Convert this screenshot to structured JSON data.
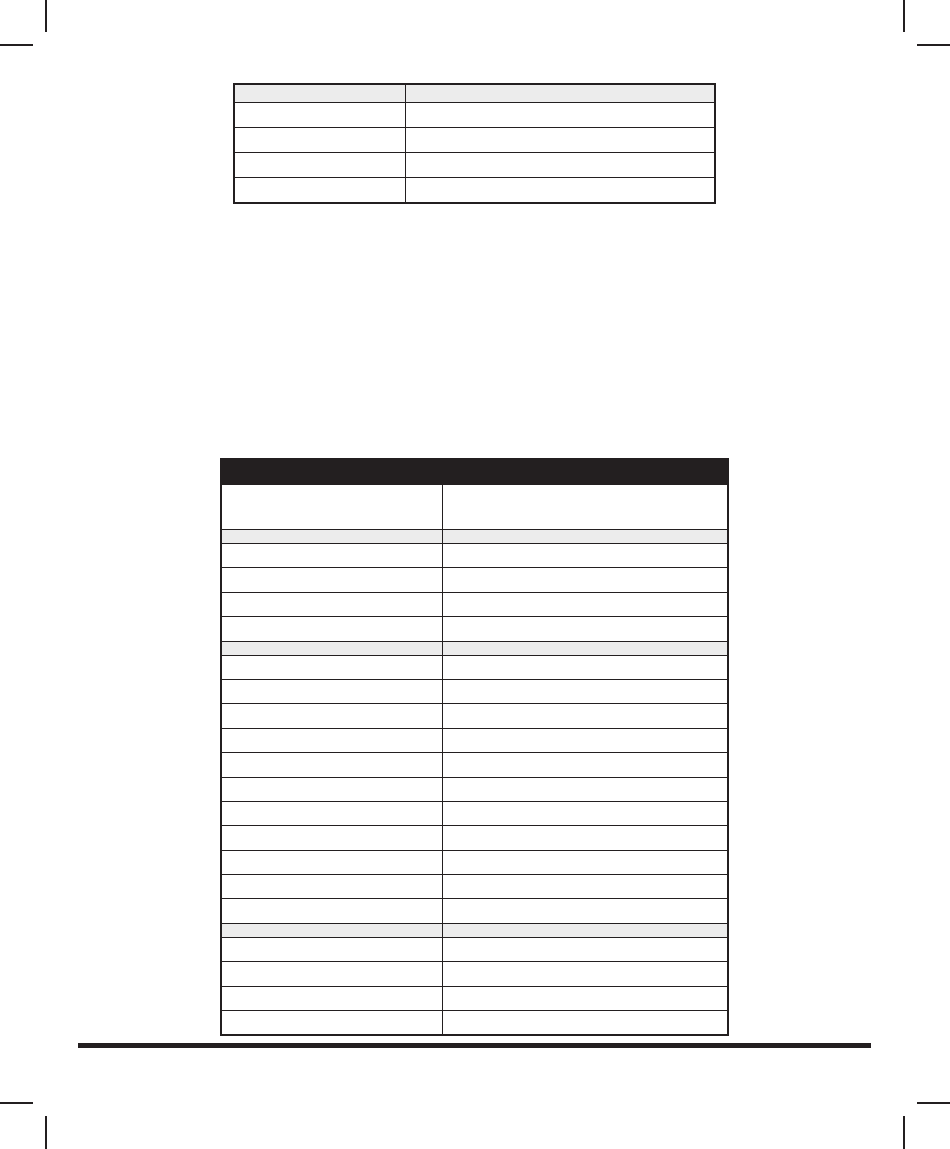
{
  "colors": {
    "page_bg": "#ffffff",
    "line": "#231f20",
    "crop_mark": "#231f20",
    "title_bar_fill": "#231f20",
    "header_row_fill": "#ececec",
    "section_row_fill": "#ececec",
    "footer_rule": "#231f20"
  },
  "top_table": {
    "rows": [
      {
        "type": "header",
        "cells": [
          "",
          ""
        ]
      },
      {
        "type": "data",
        "cells": [
          "",
          ""
        ]
      },
      {
        "type": "data",
        "cells": [
          "",
          ""
        ]
      },
      {
        "type": "data",
        "cells": [
          "",
          ""
        ]
      },
      {
        "type": "data",
        "cells": [
          "",
          ""
        ]
      }
    ]
  },
  "bottom_table": {
    "title_bar": "",
    "rows": [
      {
        "type": "colheader",
        "cells": [
          "",
          ""
        ]
      },
      {
        "type": "section",
        "cells": [
          "",
          ""
        ]
      },
      {
        "type": "data",
        "cells": [
          "",
          ""
        ]
      },
      {
        "type": "data",
        "cells": [
          "",
          ""
        ]
      },
      {
        "type": "data",
        "cells": [
          "",
          ""
        ]
      },
      {
        "type": "data",
        "cells": [
          "",
          ""
        ]
      },
      {
        "type": "section",
        "cells": [
          "",
          ""
        ]
      },
      {
        "type": "data",
        "cells": [
          "",
          ""
        ]
      },
      {
        "type": "data",
        "cells": [
          "",
          ""
        ]
      },
      {
        "type": "data",
        "cells": [
          "",
          ""
        ]
      },
      {
        "type": "data",
        "cells": [
          "",
          ""
        ]
      },
      {
        "type": "data",
        "cells": [
          "",
          ""
        ]
      },
      {
        "type": "data",
        "cells": [
          "",
          ""
        ]
      },
      {
        "type": "data",
        "cells": [
          "",
          ""
        ]
      },
      {
        "type": "data",
        "cells": [
          "",
          ""
        ]
      },
      {
        "type": "data",
        "cells": [
          "",
          ""
        ]
      },
      {
        "type": "data",
        "cells": [
          "",
          ""
        ]
      },
      {
        "type": "data",
        "cells": [
          "",
          ""
        ]
      },
      {
        "type": "section",
        "cells": [
          "",
          ""
        ]
      },
      {
        "type": "data",
        "cells": [
          "",
          ""
        ]
      },
      {
        "type": "data",
        "cells": [
          "",
          ""
        ]
      },
      {
        "type": "data",
        "cells": [
          "",
          ""
        ]
      },
      {
        "type": "data",
        "cells": [
          "",
          ""
        ]
      }
    ]
  }
}
